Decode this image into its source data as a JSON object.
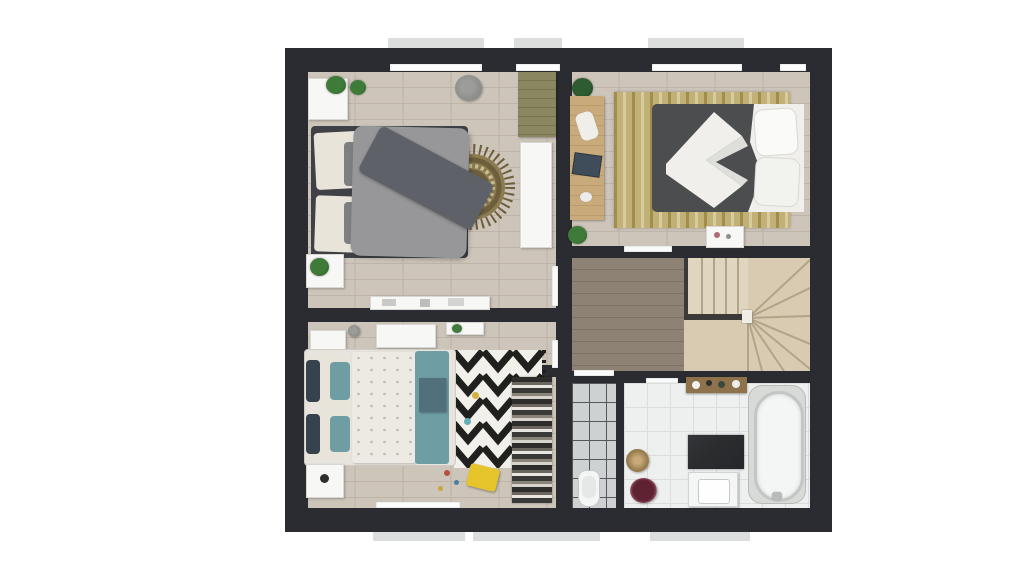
{
  "scene": {
    "type": "3d-floor-plan-render",
    "view": "top-down",
    "rooms": [
      {
        "id": "bedroom-top-left",
        "type": "bedroom",
        "features": [
          "double-bed-gray",
          "round-jute-rug",
          "wardrobe",
          "nightstands",
          "pouf",
          "plants",
          "sideboard"
        ]
      },
      {
        "id": "bedroom-top-right",
        "type": "bedroom",
        "features": [
          "double-bed-charcoal-white",
          "striped-area-rug",
          "wall-desk",
          "plants",
          "breakfast-tray"
        ]
      },
      {
        "id": "hall-landing",
        "type": "hallway",
        "features": [
          "wood-floor"
        ]
      },
      {
        "id": "staircase",
        "type": "stairs",
        "style": "winder-fan"
      },
      {
        "id": "bedroom-bottom-left",
        "type": "kids-bedroom",
        "features": [
          "bed-teal-white",
          "zigzag-rug",
          "open-closet",
          "yellow-stool",
          "toys",
          "dressers"
        ]
      },
      {
        "id": "shower-room",
        "type": "bathroom",
        "features": [
          "tiled-shower",
          "toilet"
        ]
      },
      {
        "id": "bathroom",
        "type": "bathroom",
        "features": [
          "freestanding-tub",
          "vanity-sink",
          "dark-stone-panel",
          "wood-shelf",
          "jute-basket",
          "towel-bowl"
        ]
      }
    ]
  },
  "palette": {
    "background": "#ffffff",
    "wall": "#2a2c31",
    "roof_tab": "#dcdddd",
    "floor_light": "#cbc2b6",
    "floor_plank_line": "#beb5a8",
    "hall_floor": "#8d8274",
    "hall_plank_line": "#7d7365",
    "stair_base": "#d8cbb2",
    "stair_upper": "#e0d5bf",
    "stair_line": "#b2a489",
    "stair_rail": "#3a3a38",
    "shower_tile": "#ced1d1",
    "shower_grid": "#55575b",
    "bath_tile": "#eef0f0",
    "bath_grid": "#dbdddd",
    "white_furniture": "#f7f7f5",
    "furniture_shadow": "#d8d7d4",
    "desk_wood": "#c9aa7b",
    "shelf_wood": "#8d724c",
    "olive_unit": "#8a8660",
    "rug_round_dark": "#6e5f3c",
    "rug_round_mid": "#8c7b51",
    "rug_round_light": "#cdbf97",
    "rug_stripe_base": "#c2b176",
    "rug_stripe_dark": "#a18e4d",
    "rug_stripe_light": "#d8cc9c",
    "rug_zigzag_bg": "#f2f0eb",
    "rug_zigzag_black": "#20201e",
    "bed_gray_duvet": "#97979a",
    "bed_gray_throw": "#5e6268",
    "bed_dark_duvet": "#4b4d4f",
    "bed_white": "#f0efec",
    "bed_dot_duvet": "#edeae3",
    "duvet_dot": "#c0bcb1",
    "teal": "#6e9da4",
    "teal_dark": "#52707b",
    "navy_pillow": "#36424e",
    "cream_pillow": "#e9e4da",
    "plant_green": "#3e7a38",
    "plant_dark": "#2e5c30",
    "pouf_gray": "#8b8b89",
    "accent_yellow": "#e6c42c",
    "towel_burgundy": "#5f2233",
    "jute": "#9b7e50",
    "tub_surround": "#d8dad8",
    "tub_rim": "#c4c6c6",
    "fixture_white": "#f4f5f5",
    "headboard": "#3f4146",
    "clothes_dark": "#2e2d2b",
    "dark_marble": "#2c2d2f"
  }
}
